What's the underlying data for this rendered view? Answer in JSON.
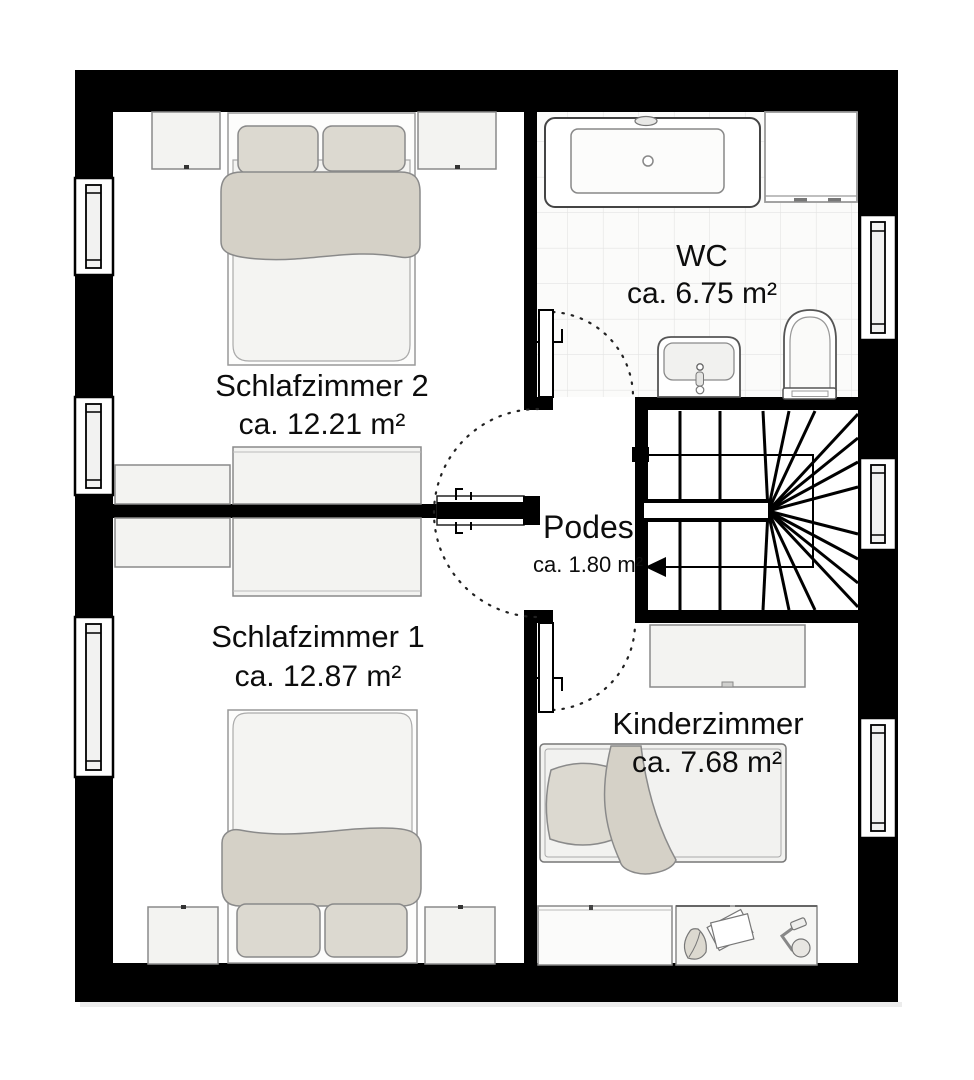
{
  "plan": {
    "rooms": {
      "schlafzimmer2": {
        "name": "Schlafzimmer 2",
        "area": "ca. 12.21 m²"
      },
      "schlafzimmer1": {
        "name": "Schlafzimmer 1",
        "area": "ca. 12.87 m²"
      },
      "wc": {
        "name": "WC",
        "area": "ca. 6.75 m²"
      },
      "podest": {
        "name": "Podes",
        "area": "ca. 1.80 m²"
      },
      "kinderzimmer": {
        "name": "Kinderzimmer",
        "area": "ca. 7.68 m²"
      }
    },
    "colors": {
      "wall": "#000000",
      "background": "#ffffff",
      "furniture_fill": "#f3f3f1",
      "textile_beige": "#d5d1c7",
      "pillow_beige": "#dcd9d0",
      "tile_line": "#e3e3e3",
      "text": "#0d0d0d"
    }
  }
}
